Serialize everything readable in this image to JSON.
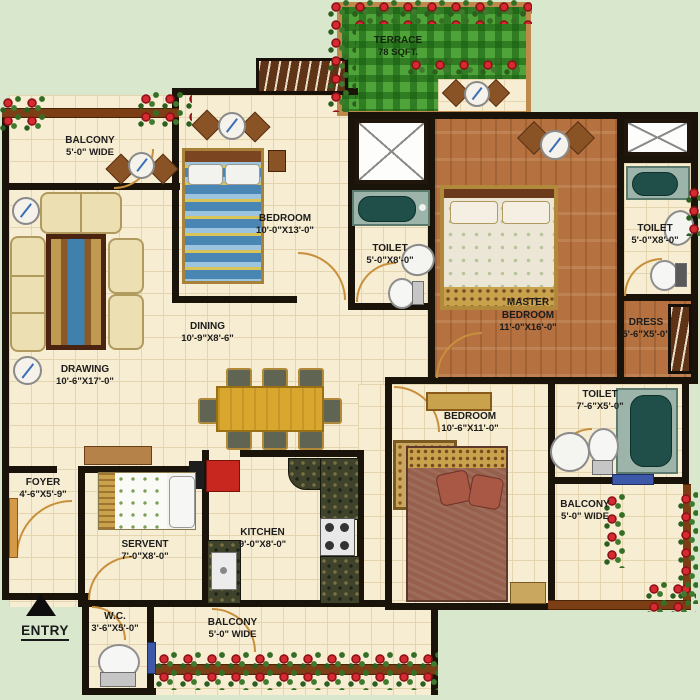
{
  "plan": {
    "entry_label": "ENTRY",
    "rooms": {
      "terrace": {
        "name": "TERRACE",
        "dims": "78 SQFT."
      },
      "balcony_top_left": {
        "name": "BALCONY",
        "dims": "5'-0\" WIDE"
      },
      "bedroom_top": {
        "name": "BEDROOM",
        "dims": "10'-0\"X13'-0\""
      },
      "toilet_middle": {
        "name": "TOILET",
        "dims": "5'-0\"X8'-0\""
      },
      "master_bedroom": {
        "name": "MASTER",
        "name2": "BEDROOM",
        "dims": "11'-0\"X16'-0\""
      },
      "toilet_top_right": {
        "name": "TOILET",
        "dims": "5'-0\"X8'-0\""
      },
      "dress": {
        "name": "DRESS",
        "dims": "5'-6\"X5'-0\""
      },
      "drawing": {
        "name": "DRAWING",
        "dims": "10'-6\"X17'-0\""
      },
      "dining": {
        "name": "DINING",
        "dims": "10'-9\"X8'-6\""
      },
      "bedroom_bottom": {
        "name": "BEDROOM",
        "dims": "10'-6\"X11'-0\""
      },
      "toilet_bottom_right": {
        "name": "TOILET",
        "dims": "7'-6\"X5'-0\""
      },
      "balcony_bottom_right": {
        "name": "BALCONY",
        "dims": "5'-0\" WIDE"
      },
      "foyer": {
        "name": "FOYER",
        "dims": "4'-6\"X5'-9\""
      },
      "servent": {
        "name": "SERVENT",
        "dims": "7'-0\"X8'-0\""
      },
      "kitchen": {
        "name": "KITCHEN",
        "dims": "9'-0\"X8'-0\""
      },
      "wc": {
        "name": "W.C.",
        "dims": "3'-6\"X5'-0\""
      },
      "balcony_bottom": {
        "name": "BALCONY",
        "dims": "5'-0\" WIDE"
      }
    },
    "colors": {
      "background": "#d9e7cc",
      "wall": "#1a1309",
      "tile_floor": "#f7edd2",
      "wood_floor": "#b5713f",
      "grass": "#4ea339",
      "railing_brown": "#7c3f15",
      "terrace_frame": "#bd8a4c",
      "flower_red": "#d42a30",
      "tub_teal": "#1f4f48",
      "window_blue": "#3d57a9",
      "dining_table": "#d9a62e"
    }
  }
}
